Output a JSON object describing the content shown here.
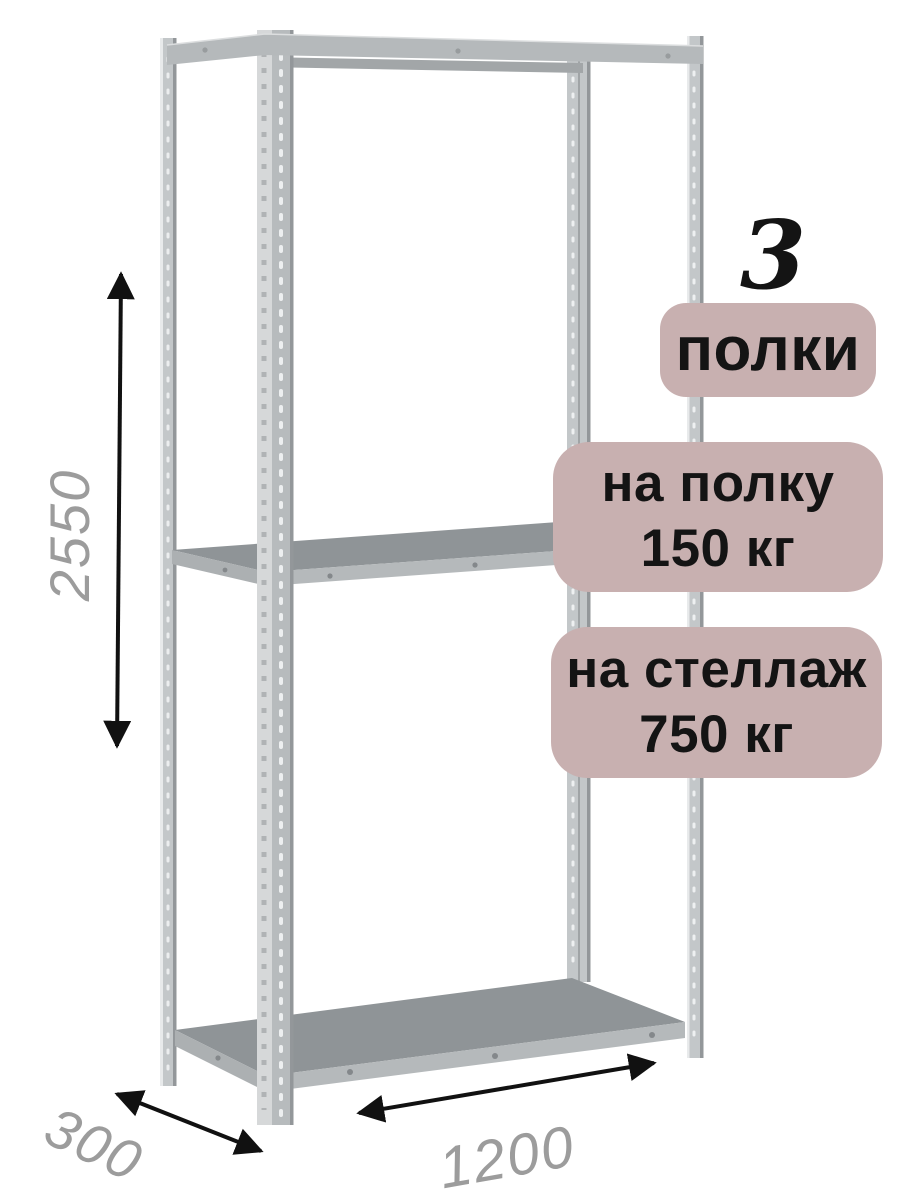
{
  "annotations": {
    "shelf_count_value": "3",
    "shelf_count_unit": "полки",
    "per_shelf_capacity_label": "на полку",
    "per_shelf_capacity_value": "150 кг",
    "per_rack_capacity_label": "на стеллаж",
    "per_rack_capacity_value": "750 кг"
  },
  "dimensions": {
    "height": "2550",
    "depth": "300",
    "width": "1200"
  },
  "colors": {
    "background": "#ffffff",
    "badge_bg": "#c8b0b0",
    "badge_text": "#141414",
    "dimension_text": "#9c9c9c",
    "arrow": "#111111",
    "metal_body": "#c3c7c9",
    "metal_light": "#d6d8d9",
    "metal_edge": "#93979a",
    "shelf_top": "#8f9497",
    "shelf_edge": "#b5b9bb"
  }
}
